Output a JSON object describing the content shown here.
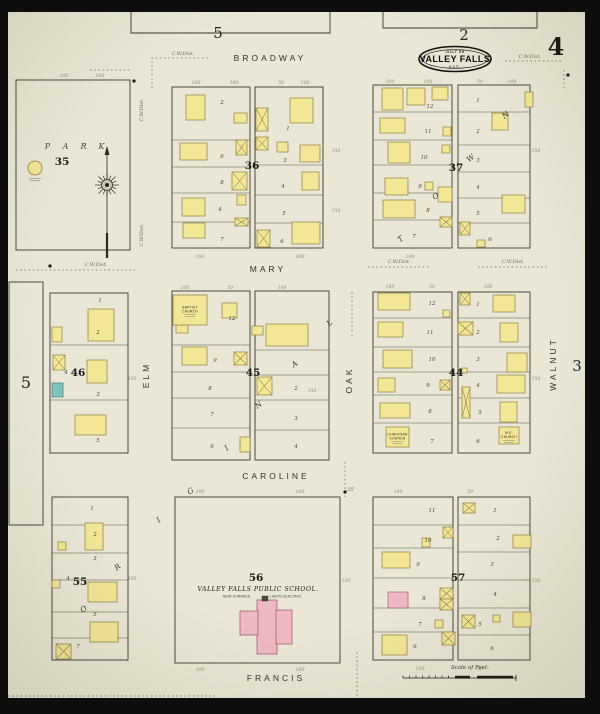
{
  "title": {
    "date": "JULY 88",
    "city": "VALLEY FALLS",
    "state": "KAS."
  },
  "page": {
    "current": "4",
    "top_left_ref": "5",
    "top_ref": "2",
    "left_ref": "5",
    "right_ref": "3"
  },
  "scale": {
    "label": "Scale of Feet."
  },
  "colors": {
    "paper": "#eae7d6",
    "frame": "#0d0d0b",
    "ink": "#3b382e",
    "lot_line": "#55523f",
    "yellow": "#f2e795",
    "yellow_stroke": "#8f7d40",
    "pink": "#efb9c3",
    "pink_stroke": "#a6616e",
    "teal": "#7fc3bf",
    "teal_stroke": "#3f7e7c",
    "dotted": "#6e6a5a"
  },
  "park": {
    "block": "35",
    "letters": [
      [
        48,
        149,
        "P"
      ],
      [
        66,
        149,
        "A"
      ],
      [
        84,
        149,
        "R"
      ],
      [
        102,
        149,
        "K"
      ]
    ]
  },
  "streets": [
    {
      "name": "BROADWAY",
      "x": 270,
      "y": 61,
      "rot": 0
    },
    {
      "name": "MARY",
      "x": 268,
      "y": 272,
      "rot": 0
    },
    {
      "name": "CAROLINE",
      "x": 276,
      "y": 479,
      "rot": 0
    },
    {
      "name": "FRANCIS",
      "x": 276,
      "y": 681,
      "rot": 0
    },
    {
      "name": "ELM",
      "x": 149,
      "y": 375,
      "rot": -90
    },
    {
      "name": "OAK",
      "x": 352,
      "y": 380,
      "rot": -90
    },
    {
      "name": "WALNUT",
      "x": 556,
      "y": 364,
      "rot": -90
    }
  ],
  "blocks": [
    {
      "number": "35",
      "num": [
        62,
        165
      ],
      "parts": [
        {
          "x": 16,
          "y": 80,
          "w": 114,
          "h": 170,
          "rows": []
        }
      ]
    },
    {
      "number": "36",
      "num": [
        252,
        169
      ],
      "parts": [
        {
          "x": 172,
          "y": 87,
          "w": 78,
          "h": 161,
          "rows": [
            140,
            167,
            193,
            222
          ]
        },
        {
          "x": 255,
          "y": 87,
          "w": 68,
          "h": 161,
          "rows": [
            165,
            195,
            223
          ]
        }
      ]
    },
    {
      "number": "37",
      "num": [
        456,
        171
      ],
      "parts": [
        {
          "x": 373,
          "y": 85,
          "w": 79,
          "h": 163,
          "rows": [
            112,
            140,
            165,
            193,
            220
          ]
        },
        {
          "x": 458,
          "y": 85,
          "w": 72,
          "h": 163,
          "rows": [
            112,
            145,
            172,
            198,
            223
          ]
        }
      ]
    },
    {
      "number": "46",
      "num": [
        78,
        376
      ],
      "parts": [
        {
          "x": 50,
          "y": 293,
          "w": 78,
          "h": 160,
          "rows": [
            345,
            400
          ]
        }
      ]
    },
    {
      "number": "45",
      "num": [
        253,
        376
      ],
      "parts": [
        {
          "x": 172,
          "y": 291,
          "w": 78,
          "h": 169,
          "rows": [
            345,
            372,
            398,
            428
          ]
        },
        {
          "x": 255,
          "y": 291,
          "w": 74,
          "h": 169,
          "rows": [
            350,
            375,
            400,
            430
          ]
        }
      ]
    },
    {
      "number": "44",
      "num": [
        456,
        376
      ],
      "parts": [
        {
          "x": 373,
          "y": 292,
          "w": 79,
          "h": 161,
          "rows": [
            318,
            347,
            372,
            395,
            423
          ]
        },
        {
          "x": 458,
          "y": 292,
          "w": 72,
          "h": 161,
          "rows": [
            318,
            347,
            372,
            398,
            423
          ]
        }
      ]
    },
    {
      "number": "55",
      "num": [
        80,
        585
      ],
      "parts": [
        {
          "x": 52,
          "y": 497,
          "w": 76,
          "h": 163,
          "rows": [
            525,
            553,
            580,
            612,
            638
          ]
        }
      ]
    },
    {
      "number": "56",
      "num": [
        256,
        581
      ],
      "parts": [
        {
          "x": 175,
          "y": 497,
          "w": 165,
          "h": 166,
          "rows": []
        }
      ]
    },
    {
      "number": "57",
      "num": [
        458,
        581
      ],
      "parts": [
        {
          "x": 373,
          "y": 497,
          "w": 80,
          "h": 163,
          "rows": [
            525,
            548,
            578,
            608,
            632
          ]
        },
        {
          "x": 458,
          "y": 497,
          "w": 72,
          "h": 163,
          "rows": [
            525,
            552,
            580,
            608,
            635
          ]
        }
      ]
    }
  ],
  "buildings": [
    [
      186,
      95,
      19,
      25,
      "y",
      0
    ],
    [
      234,
      113,
      13,
      10,
      "y",
      0
    ],
    [
      236,
      140,
      11,
      15,
      "y",
      1
    ],
    [
      180,
      143,
      27,
      17,
      "y",
      0
    ],
    [
      232,
      172,
      15,
      18,
      "y",
      1
    ],
    [
      237,
      195,
      9,
      10,
      "y",
      0
    ],
    [
      182,
      198,
      23,
      18,
      "y",
      0
    ],
    [
      235,
      218,
      13,
      8,
      "y",
      1
    ],
    [
      183,
      223,
      22,
      15,
      "y",
      0
    ],
    [
      256,
      108,
      12,
      23,
      "y",
      1
    ],
    [
      256,
      137,
      12,
      13,
      "y",
      1
    ],
    [
      290,
      98,
      23,
      25,
      "y",
      0
    ],
    [
      277,
      142,
      11,
      10,
      "y",
      0
    ],
    [
      300,
      145,
      20,
      17,
      "y",
      0
    ],
    [
      302,
      172,
      17,
      18,
      "y",
      0
    ],
    [
      257,
      230,
      13,
      17,
      "y",
      1
    ],
    [
      292,
      222,
      28,
      22,
      "y",
      0
    ],
    [
      382,
      88,
      21,
      22,
      "y",
      0
    ],
    [
      407,
      88,
      18,
      17,
      "y",
      0
    ],
    [
      432,
      87,
      16,
      13,
      "y",
      0
    ],
    [
      380,
      118,
      25,
      15,
      "y",
      0
    ],
    [
      443,
      127,
      8,
      9,
      "y",
      0
    ],
    [
      388,
      142,
      22,
      21,
      "y",
      0
    ],
    [
      442,
      145,
      8,
      8,
      "y",
      0
    ],
    [
      385,
      178,
      23,
      17,
      "y",
      0
    ],
    [
      425,
      182,
      8,
      8,
      "y",
      0
    ],
    [
      438,
      187,
      14,
      15,
      "y",
      0
    ],
    [
      383,
      200,
      32,
      18,
      "y",
      0
    ],
    [
      440,
      217,
      12,
      10,
      "y",
      1
    ],
    [
      525,
      92,
      8,
      15,
      "y",
      0
    ],
    [
      492,
      113,
      16,
      17,
      "y",
      0
    ],
    [
      502,
      195,
      23,
      18,
      "y",
      0
    ],
    [
      460,
      222,
      10,
      13,
      "y",
      1
    ],
    [
      477,
      240,
      8,
      7,
      "y",
      0
    ],
    [
      88,
      309,
      26,
      32,
      "y",
      0
    ],
    [
      52,
      327,
      10,
      15,
      "y",
      0
    ],
    [
      53,
      355,
      12,
      15,
      "y",
      1
    ],
    [
      87,
      360,
      20,
      23,
      "y",
      0
    ],
    [
      52,
      383,
      11,
      14,
      "t",
      0
    ],
    [
      75,
      415,
      31,
      20,
      "y",
      0
    ],
    [
      176,
      325,
      12,
      8,
      "y",
      0
    ],
    [
      222,
      303,
      15,
      15,
      "y",
      0
    ],
    [
      182,
      347,
      25,
      18,
      "y",
      0
    ],
    [
      234,
      352,
      13,
      13,
      "y",
      1
    ],
    [
      240,
      437,
      10,
      15,
      "y",
      0
    ],
    [
      266,
      324,
      42,
      22,
      "y",
      0
    ],
    [
      252,
      326,
      11,
      9,
      "y",
      0
    ],
    [
      257,
      377,
      15,
      18,
      "y",
      1
    ],
    [
      378,
      293,
      32,
      17,
      "y",
      0
    ],
    [
      378,
      322,
      25,
      15,
      "y",
      0
    ],
    [
      443,
      310,
      7,
      7,
      "y",
      0
    ],
    [
      383,
      350,
      29,
      18,
      "y",
      0
    ],
    [
      378,
      378,
      17,
      14,
      "y",
      0
    ],
    [
      440,
      380,
      10,
      10,
      "y",
      1
    ],
    [
      380,
      403,
      30,
      15,
      "y",
      0
    ],
    [
      460,
      293,
      10,
      12,
      "y",
      1
    ],
    [
      493,
      295,
      22,
      17,
      "y",
      0
    ],
    [
      458,
      322,
      15,
      13,
      "y",
      1
    ],
    [
      500,
      323,
      18,
      19,
      "y",
      0
    ],
    [
      507,
      353,
      20,
      19,
      "y",
      0
    ],
    [
      462,
      368,
      5,
      5,
      "y",
      0
    ],
    [
      497,
      375,
      28,
      18,
      "y",
      0
    ],
    [
      462,
      387,
      8,
      31,
      "y",
      1
    ],
    [
      500,
      402,
      17,
      20,
      "y",
      0
    ],
    [
      85,
      523,
      18,
      27,
      "y",
      0
    ],
    [
      58,
      542,
      8,
      8,
      "y",
      0
    ],
    [
      52,
      580,
      8,
      8,
      "y",
      0
    ],
    [
      88,
      582,
      29,
      20,
      "y",
      0
    ],
    [
      90,
      622,
      28,
      20,
      "y",
      0
    ],
    [
      56,
      644,
      15,
      15,
      "y",
      1
    ],
    [
      443,
      527,
      10,
      11,
      "y",
      1
    ],
    [
      422,
      538,
      8,
      9,
      "y",
      0
    ],
    [
      382,
      552,
      28,
      16,
      "y",
      0
    ],
    [
      388,
      592,
      20,
      16,
      "p",
      0
    ],
    [
      440,
      588,
      13,
      11,
      "y",
      1
    ],
    [
      440,
      599,
      13,
      11,
      "y",
      1
    ],
    [
      435,
      620,
      8,
      8,
      "y",
      0
    ],
    [
      442,
      632,
      13,
      13,
      "y",
      1
    ],
    [
      382,
      635,
      25,
      20,
      "y",
      0
    ],
    [
      463,
      503,
      12,
      10,
      "y",
      1
    ],
    [
      513,
      535,
      18,
      13,
      "y",
      0
    ],
    [
      462,
      615,
      13,
      13,
      "y",
      1
    ],
    [
      493,
      615,
      7,
      7,
      "y",
      0
    ],
    [
      513,
      612,
      18,
      15,
      "y",
      0
    ]
  ],
  "labeled_buildings": [
    {
      "x": 173,
      "y": 295,
      "w": 34,
      "h": 30,
      "color": "y",
      "label": [
        "BAPTIST",
        "CHURCH"
      ]
    },
    {
      "x": 386,
      "y": 427,
      "w": 23,
      "h": 20,
      "color": "y",
      "label": [
        "CHRISTIAN",
        "CHURCH"
      ]
    },
    {
      "x": 499,
      "y": 427,
      "w": 20,
      "h": 17,
      "color": "y",
      "label": [
        "M.E.",
        "CHURCH"
      ]
    }
  ],
  "school": {
    "name": "VALLEY FALLS PUBLIC SCHOOL.",
    "sub_left": "HEAT FURNACE.",
    "sub_right": "LIGHTS ELECTRIC.",
    "rects": [
      [
        257,
        600,
        20,
        54
      ],
      [
        240,
        611,
        18,
        24
      ],
      [
        276,
        610,
        16,
        34
      ]
    ],
    "chimney": [
      262,
      596,
      6,
      5
    ]
  },
  "boundary_letters": {
    "spells": "ORIGINAL TOWN",
    "rot": -38,
    "letters": [
      [
        85,
        611,
        "O"
      ],
      [
        119,
        569,
        "R"
      ],
      [
        160,
        522,
        "I"
      ],
      [
        192,
        493,
        "G"
      ],
      [
        228,
        450,
        "I"
      ],
      [
        260,
        407,
        "N"
      ],
      [
        296,
        366,
        "A"
      ],
      [
        331,
        325,
        "L"
      ],
      [
        402,
        241,
        "T"
      ],
      [
        437,
        198,
        "O"
      ],
      [
        472,
        160,
        "W"
      ],
      [
        507,
        117,
        "N"
      ]
    ]
  },
  "annotations": [
    {
      "t": "C.W.Dist.",
      "x": 183,
      "y": 55,
      "rot": 0
    },
    {
      "t": "C.W.Dist.",
      "x": 530,
      "y": 58,
      "rot": 0
    },
    {
      "t": "C.W.Dist.",
      "x": 96,
      "y": 266,
      "rot": 0
    },
    {
      "t": "C.W.Dist.",
      "x": 399,
      "y": 263,
      "rot": 0
    },
    {
      "t": "C.W.Dist.",
      "x": 513,
      "y": 263,
      "rot": 0
    },
    {
      "t": "C.W.Dist.",
      "x": 143,
      "y": 110,
      "rot": -90
    },
    {
      "t": "C.W.Dist.",
      "x": 143,
      "y": 235,
      "rot": -90
    },
    {
      "t": "25'",
      "x": 351,
      "y": 491,
      "rot": 0
    }
  ],
  "dotted_lines": [
    [
      [
        152,
        88
      ],
      [
        152,
        58
      ],
      [
        208,
        58
      ]
    ],
    [
      [
        90,
        70
      ],
      [
        130,
        70
      ]
    ],
    [
      [
        505,
        61
      ],
      [
        563,
        61
      ]
    ],
    [
      [
        16,
        270
      ],
      [
        137,
        270
      ]
    ],
    [
      [
        368,
        267
      ],
      [
        430,
        267
      ]
    ],
    [
      [
        478,
        267
      ],
      [
        548,
        267
      ]
    ],
    [
      [
        352,
        292
      ],
      [
        352,
        338
      ]
    ],
    [
      [
        345,
        462
      ],
      [
        345,
        497
      ]
    ],
    [
      [
        357,
        652
      ],
      [
        357,
        697
      ]
    ],
    [
      [
        8,
        696
      ],
      [
        215,
        696
      ]
    ],
    [
      [
        564,
        70
      ],
      [
        564,
        88
      ]
    ]
  ],
  "dots": [
    [
      134,
      81
    ],
    [
      568,
      75
    ],
    [
      345,
      492
    ],
    [
      50,
      266
    ]
  ],
  "lot_numbers": [
    [
      222,
      104,
      "2"
    ],
    [
      222,
      158,
      "6"
    ],
    [
      222,
      184,
      "8"
    ],
    [
      220,
      211,
      "4"
    ],
    [
      222,
      241,
      "7"
    ],
    [
      288,
      130,
      "1"
    ],
    [
      285,
      162,
      "3"
    ],
    [
      283,
      188,
      "4"
    ],
    [
      284,
      215,
      "5"
    ],
    [
      282,
      243,
      "6"
    ],
    [
      430,
      108,
      "12"
    ],
    [
      428,
      133,
      "11"
    ],
    [
      424,
      159,
      "10"
    ],
    [
      420,
      188,
      "9"
    ],
    [
      428,
      212,
      "8"
    ],
    [
      414,
      238,
      "7"
    ],
    [
      478,
      102,
      "1"
    ],
    [
      478,
      133,
      "2"
    ],
    [
      478,
      162,
      "3"
    ],
    [
      478,
      189,
      "4"
    ],
    [
      478,
      215,
      "5"
    ],
    [
      490,
      241,
      "6"
    ],
    [
      432,
      305,
      "12"
    ],
    [
      430,
      334,
      "11"
    ],
    [
      432,
      361,
      "10"
    ],
    [
      428,
      387,
      "9"
    ],
    [
      430,
      413,
      "8"
    ],
    [
      432,
      443,
      "7"
    ],
    [
      478,
      306,
      "1"
    ],
    [
      478,
      334,
      "2"
    ],
    [
      478,
      361,
      "3"
    ],
    [
      478,
      387,
      "4"
    ],
    [
      480,
      414,
      "5"
    ],
    [
      478,
      443,
      "6"
    ],
    [
      232,
      320,
      "12"
    ],
    [
      215,
      362,
      "9"
    ],
    [
      210,
      390,
      "8"
    ],
    [
      212,
      416,
      "7"
    ],
    [
      212,
      448,
      "6"
    ],
    [
      296,
      390,
      "2"
    ],
    [
      296,
      420,
      "3"
    ],
    [
      296,
      448,
      "4"
    ],
    [
      100,
      302,
      "1"
    ],
    [
      98,
      334,
      "2"
    ],
    [
      66,
      374,
      "4"
    ],
    [
      98,
      396,
      "3"
    ],
    [
      98,
      442,
      "5"
    ],
    [
      92,
      510,
      "1"
    ],
    [
      95,
      536,
      "2"
    ],
    [
      95,
      560,
      "3"
    ],
    [
      68,
      580,
      "4"
    ],
    [
      95,
      616,
      "5"
    ],
    [
      78,
      648,
      "7"
    ],
    [
      432,
      512,
      "11"
    ],
    [
      428,
      542,
      "10"
    ],
    [
      418,
      566,
      "9"
    ],
    [
      424,
      600,
      "8"
    ],
    [
      420,
      626,
      "7"
    ],
    [
      415,
      648,
      "6"
    ],
    [
      495,
      512,
      "1"
    ],
    [
      498,
      540,
      "2"
    ],
    [
      492,
      566,
      "3"
    ],
    [
      495,
      596,
      "4"
    ],
    [
      480,
      626,
      "5"
    ],
    [
      492,
      650,
      "6"
    ]
  ],
  "dimensions": [
    [
      196,
      84,
      "100"
    ],
    [
      234,
      84,
      "100"
    ],
    [
      281,
      84,
      "50"
    ],
    [
      305,
      84,
      "100"
    ],
    [
      390,
      83,
      "100"
    ],
    [
      428,
      83,
      "100"
    ],
    [
      480,
      83,
      "50"
    ],
    [
      512,
      83,
      "100"
    ],
    [
      64,
      77,
      "100"
    ],
    [
      100,
      77,
      "100"
    ],
    [
      185,
      289,
      "100"
    ],
    [
      230,
      289,
      "50"
    ],
    [
      282,
      289,
      "100"
    ],
    [
      390,
      288,
      "100"
    ],
    [
      432,
      288,
      "50"
    ],
    [
      488,
      288,
      "100"
    ],
    [
      200,
      493,
      "100"
    ],
    [
      300,
      493,
      "100"
    ],
    [
      398,
      493,
      "100"
    ],
    [
      470,
      493,
      "50"
    ],
    [
      336,
      152,
      "150"
    ],
    [
      336,
      212,
      "150"
    ],
    [
      536,
      152,
      "150"
    ],
    [
      132,
      380,
      "150"
    ],
    [
      312,
      392,
      "150"
    ],
    [
      536,
      380,
      "150"
    ],
    [
      132,
      580,
      "150"
    ],
    [
      346,
      582,
      "150"
    ],
    [
      536,
      582,
      "150"
    ],
    [
      200,
      258,
      "100"
    ],
    [
      300,
      258,
      "100"
    ],
    [
      410,
      258,
      "100"
    ],
    [
      200,
      671,
      "100"
    ],
    [
      300,
      671,
      "100"
    ],
    [
      420,
      670,
      "100"
    ],
    [
      480,
      670,
      "50"
    ]
  ]
}
